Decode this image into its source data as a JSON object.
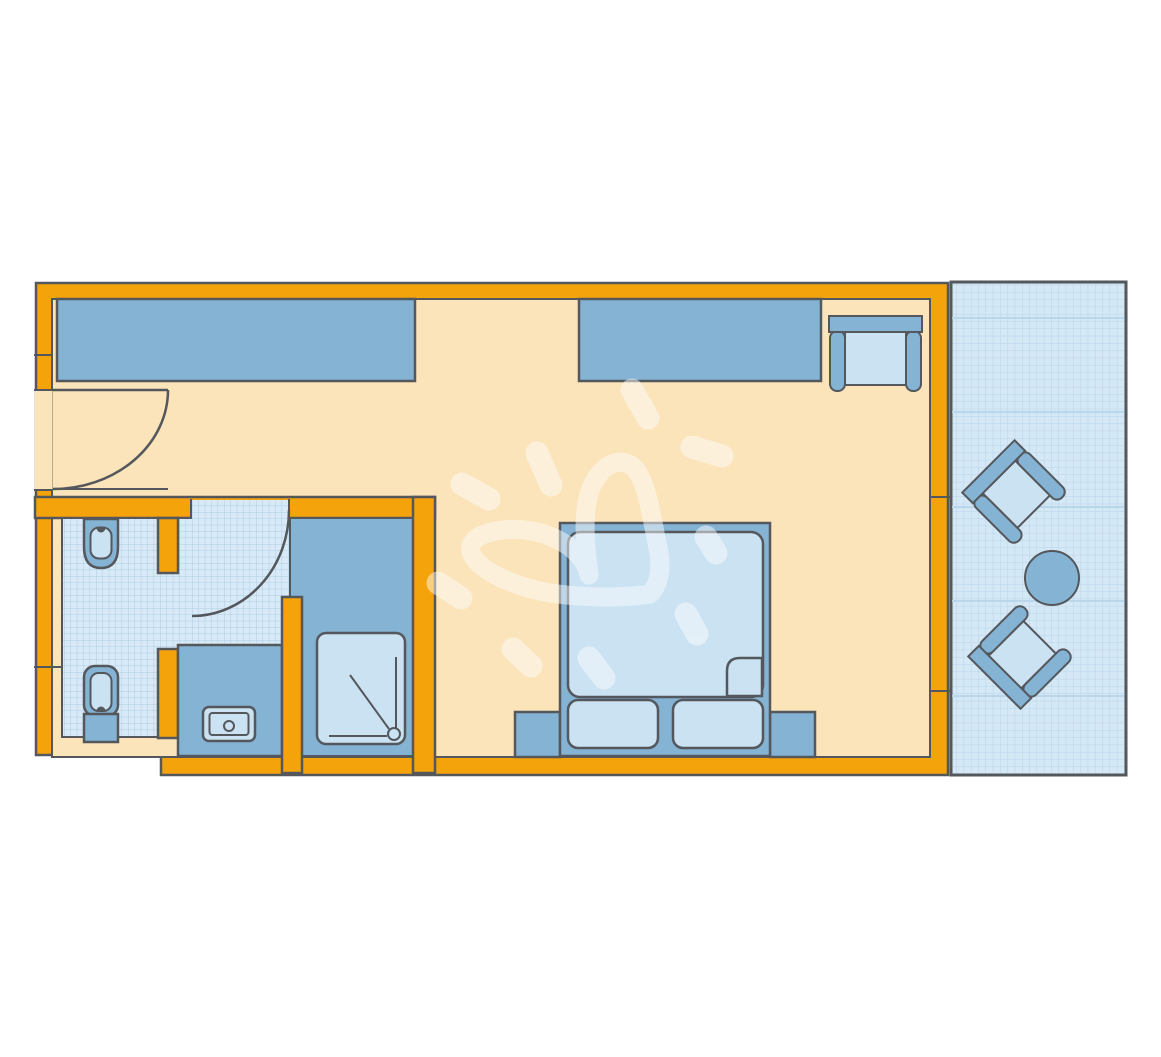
{
  "colors": {
    "background": "#FFFFFF",
    "wall": "#F5A30B",
    "outline": "#54575C",
    "floor": "#FBE3BA",
    "furniture": "#85B3D3",
    "furniture_light": "#CBE2F2",
    "tile_bg": "#D8EAF7",
    "tile_line": "#AECDE4",
    "balcony_bg": "#D5E8F5",
    "balcony_line": "#B7D5EA",
    "watermark": "#FFFFFF"
  },
  "plan": {
    "kind": "hotel-room-floor-plan",
    "symbols": [
      "entrance-door",
      "wardrobe",
      "sideboard",
      "desk-chair",
      "bathroom-door",
      "wall-hung-toilet",
      "toilet",
      "vanity-washbasin",
      "shower-tray",
      "double-bed",
      "pillows",
      "nightstands",
      "balcony-terrace",
      "balcony-chairs",
      "balcony-round-table",
      "sun-heart-watermark"
    ]
  }
}
